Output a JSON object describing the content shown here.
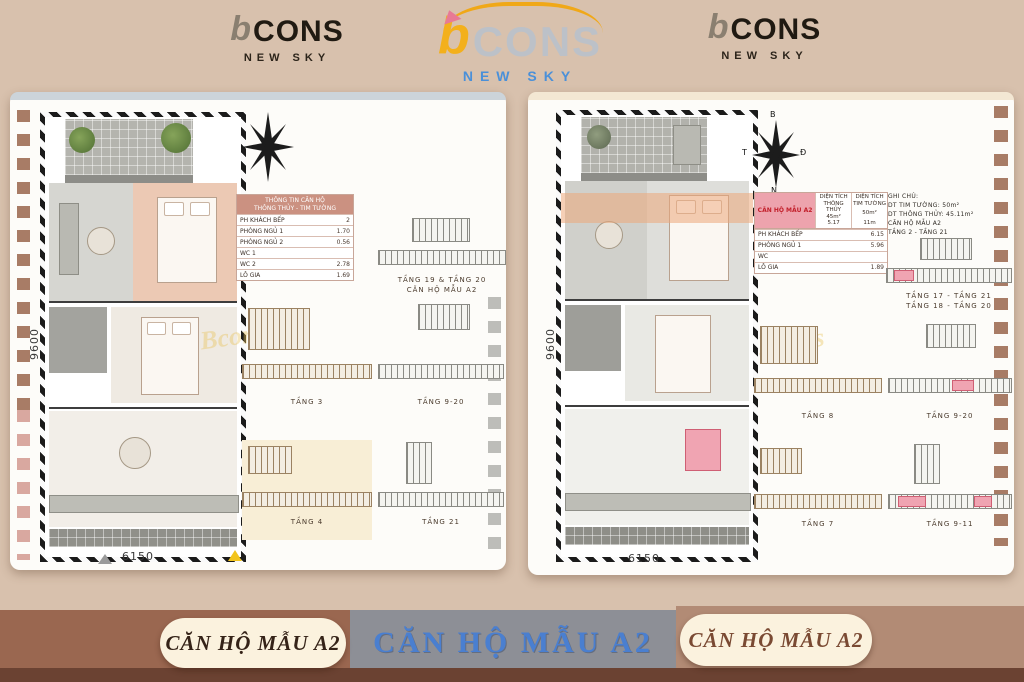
{
  "logos": {
    "left": {
      "b": "b",
      "name": "CONS",
      "sub": "NEW SKY"
    },
    "center": {
      "b": "b",
      "name": "CONS",
      "sub": "NEW SKY"
    },
    "right": {
      "b": "b",
      "name": "CONS",
      "sub": "NEW SKY"
    }
  },
  "footer": {
    "left": "CĂN HỘ MẪU A2",
    "center": "CĂN HỘ MẪU A2",
    "right": "CĂN HỘ MẪU A2"
  },
  "colors": {
    "brand_yellow": "#f3b01c",
    "caption_blue": "#4a7fd0",
    "highlight_pink": "#eda3ad"
  },
  "left_panel": {
    "watermark": "Bcons",
    "dims": {
      "width": "6150",
      "height": "9600"
    },
    "table": {
      "title_line1": "THÔNG TIN CĂN HỘ",
      "title_line2": "THÔNG THỦY - TIM TƯỜNG",
      "rows": [
        {
          "label": "PH KHÁCH BẾP",
          "value": "2"
        },
        {
          "label": "PHÒNG NGỦ 1",
          "value": "1.70"
        },
        {
          "label": "PHÒNG NGỦ 2",
          "value": "0.56"
        },
        {
          "label": "WC 1",
          "value": ""
        },
        {
          "label": "WC 2",
          "value": "2.78"
        },
        {
          "label": "LÔ GIA",
          "value": "1.69"
        }
      ]
    },
    "keyplans": {
      "top_line1": "TẦNG 19 & TẦNG 20",
      "top_line2": "CĂN HỘ MẪU A2",
      "mid_left": "TẦNG 3",
      "mid_right": "TẦNG 9-20",
      "bot_left": "TẦNG 4",
      "bot_right": "TẦNG 21"
    }
  },
  "right_panel": {
    "watermark": "Bcons",
    "dims": {
      "width": "6150",
      "height": "9600"
    },
    "compass": {
      "n": "B",
      "e": "Đ",
      "s": "N",
      "w": "T"
    },
    "table": {
      "highlight": "CĂN HỘ MẪU A2",
      "col1_title": "DIỆN TÍCH THÔNG THỦY",
      "col2_title": "DIỆN TÍCH TIM TƯỜNG",
      "col1_area": "45m²",
      "col2_area": "50m²",
      "col1_dim": "5.17",
      "col2_dim": "11m",
      "rows": [
        {
          "label": "PH KHÁCH BẾP",
          "value": "6.15"
        },
        {
          "label": "PHÒNG NGỦ 1",
          "value": "5.96"
        },
        {
          "label": "WC",
          "value": ""
        },
        {
          "label": "LÔ GIA",
          "value": "1.89"
        }
      ]
    },
    "notes": [
      "GHI CHÚ:",
      "DT TIM TƯỜNG: 50m²",
      "DT THÔNG THỦY: 45.11m²",
      "CĂN HỘ MẪU A2",
      "TẦNG 2 - TẦNG 21"
    ],
    "keyplans": {
      "top_line1": "TẦNG 17 - TẦNG 21",
      "top_line2": "TẦNG 18 - TẦNG 20",
      "mid_left": "TẦNG 8",
      "mid_right": "TẦNG 9-20",
      "bot_left": "TẦNG 7",
      "bot_right": "TẦNG 9-11"
    }
  }
}
